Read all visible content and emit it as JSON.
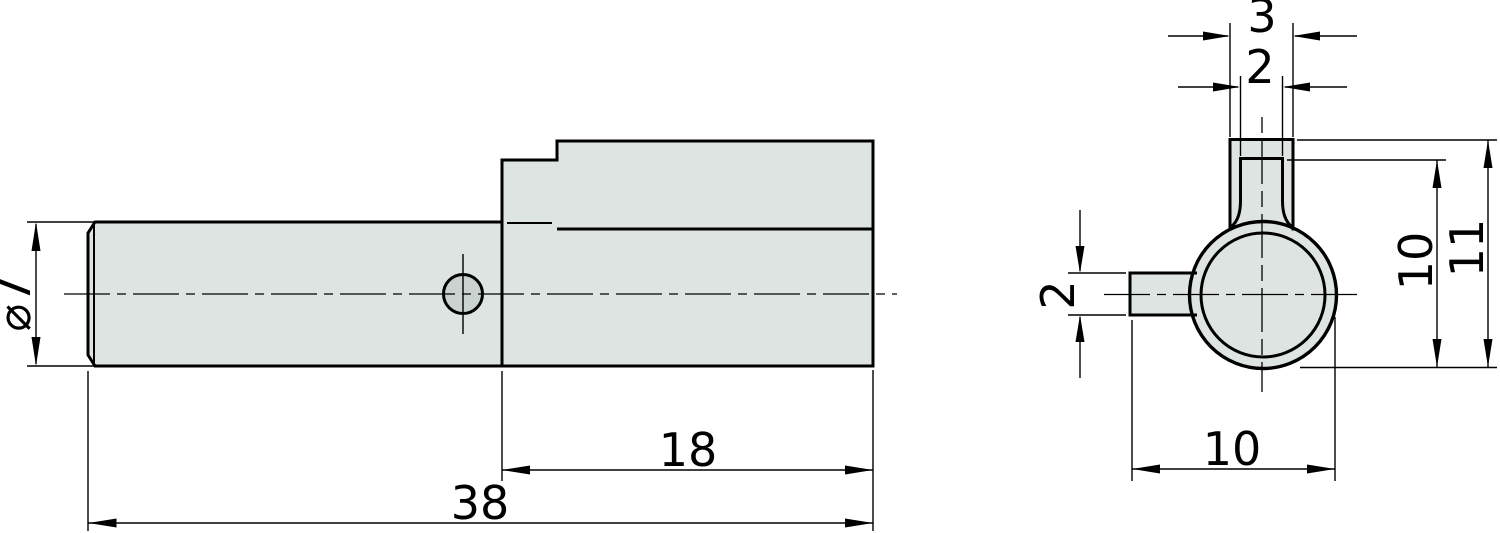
{
  "drawing": {
    "kind": "two-view technical drawing of a shaft with top fin and side pin",
    "colors": {
      "background": "#ffffff",
      "part_fill": "#dde4e2",
      "hole_fill": "#cbd3d1",
      "line": "#000000"
    },
    "side_view": {
      "dim_diameter": "⌀7",
      "dim_fin_length": "18",
      "dim_total_length": "38"
    },
    "end_view": {
      "dim_tab_outer_width": "3",
      "dim_tab_inner_width": "2",
      "dim_pin_height": "2",
      "dim_width_total": "10",
      "dim_height_step": "10",
      "dim_height_total": "11"
    }
  }
}
